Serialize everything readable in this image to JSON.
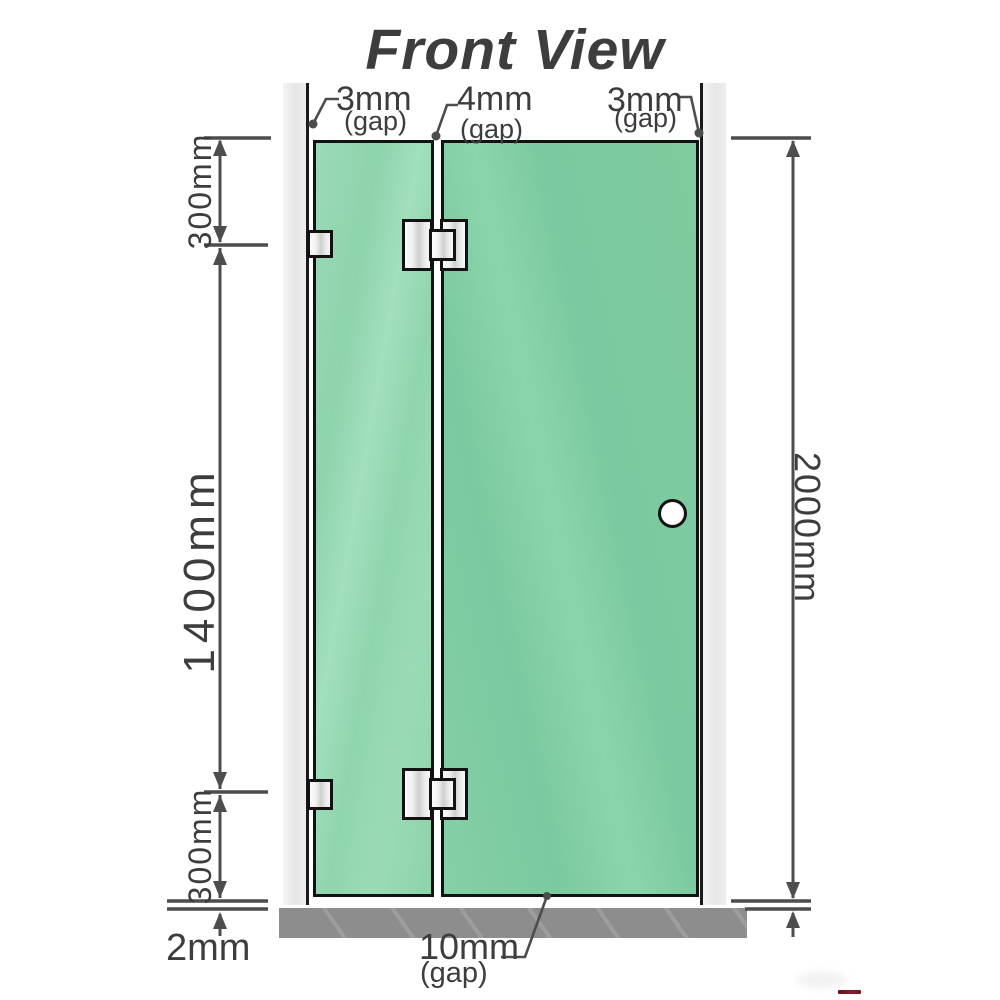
{
  "title": "Front View",
  "annotations": {
    "gap_left": {
      "value": "3mm",
      "suffix": "(gap)"
    },
    "gap_middle": {
      "value": "4mm",
      "suffix": "(gap)"
    },
    "gap_right": {
      "value": "3mm",
      "suffix": "(gap)"
    },
    "gap_bottom": {
      "value": "10mm",
      "suffix": "(gap)"
    },
    "floor_offset": {
      "value": "2mm"
    }
  },
  "dimensions": {
    "left_top": "300mm",
    "left_middle": "1400mm",
    "left_bottom": "300mm",
    "right_overall": "2000mm"
  },
  "colors": {
    "title_gray": "#a2a2a2",
    "dimension_line": "#4d4d4d",
    "text": "#3d3d3d",
    "glass_left": "#8ed3ac",
    "glass_right": "#7bc9a0",
    "wall_gray": "#ececec",
    "floor_gray": "#8d8d8d",
    "hinge_metal": "#e0e0e0",
    "outline_black": "#121212",
    "logo_red": "#701a28"
  }
}
